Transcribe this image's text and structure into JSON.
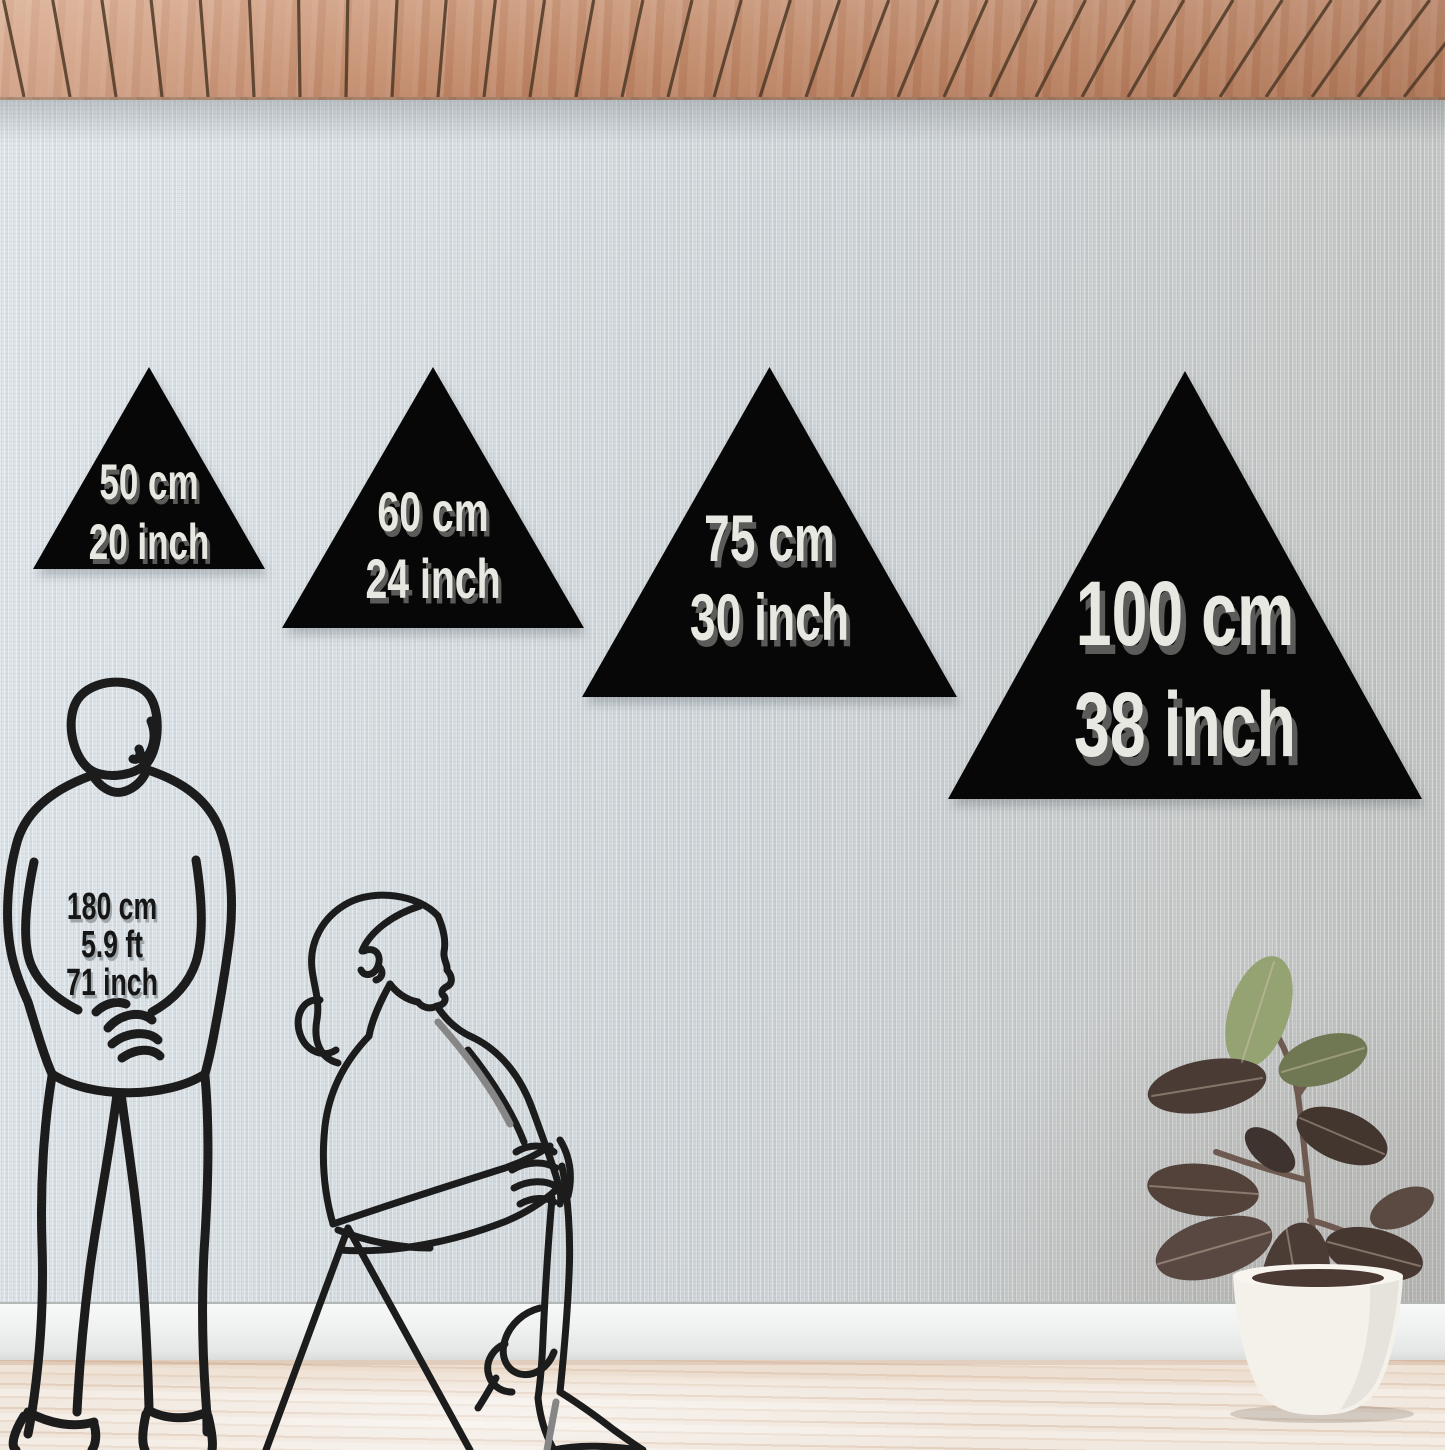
{
  "sizes": [
    {
      "cm": "50 cm",
      "inch": "20 inch"
    },
    {
      "cm": "60 cm",
      "inch": "24 inch"
    },
    {
      "cm": "75 cm",
      "inch": "30 inch"
    },
    {
      "cm": "100 cm",
      "inch": "38 inch"
    }
  ],
  "person": {
    "lines": [
      "180 cm",
      "5.9 ft",
      "71 inch"
    ]
  },
  "colors": {
    "triangle": "#070707",
    "triangle_text": "#e8e8e2",
    "triangle_text_shadow": "#606060",
    "person_text": "#161616",
    "wood_ceiling": "#c38b6b",
    "wall_left": "#dde6ec",
    "wall_right": "#bcbebc",
    "baseboard": "#eff2f0",
    "floor": "#f1e9e0",
    "line_art": "#1c1c1c"
  }
}
